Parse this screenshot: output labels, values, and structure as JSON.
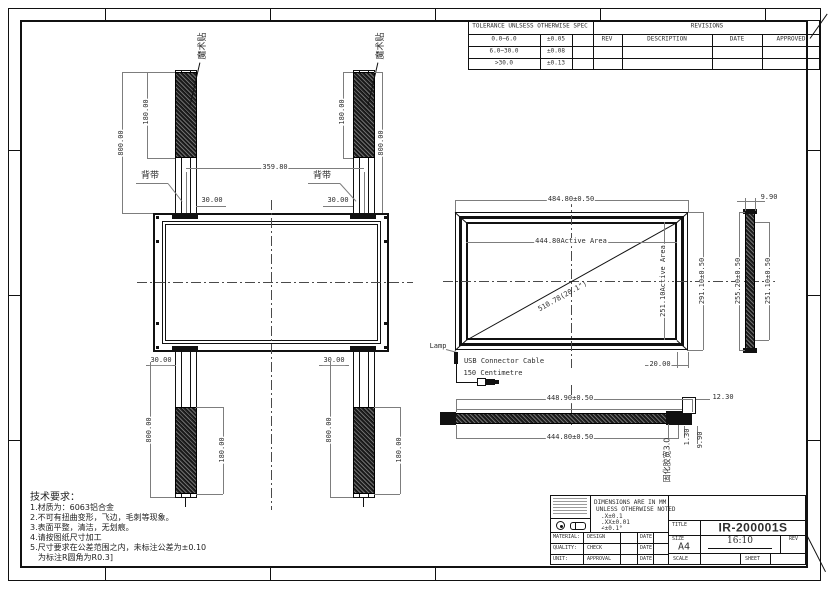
{
  "tables": {
    "tolerance": {
      "title": "TOLERANCE UNLSESS OTHERWISE SPEC",
      "rows": [
        {
          "range": "0.0~6.0",
          "tol": "±0.05"
        },
        {
          "range": "6.0~30.0",
          "tol": "±0.08"
        },
        {
          "range": ">30.0",
          "tol": "±0.13"
        }
      ]
    },
    "revisions": {
      "title": "REVISIONS",
      "col_rev": "REV",
      "col_desc": "DESCRIPTION",
      "col_date": "DATE",
      "col_approved": "APPROVED"
    }
  },
  "strap_view": {
    "velcro_label": "魔术贴",
    "strap_label": "背带",
    "velcro_length": "180.00",
    "strap_length": "800.00",
    "strap_spacing": "359.80",
    "strap_offset": "30.00"
  },
  "front_view": {
    "outer_width": "484.80±0.50",
    "active_width": "444.80Active Area",
    "active_height": "251.10Active Area",
    "outer_height": "291.10±0.50",
    "diagonal": "510.78(20.1\")",
    "corner_dim": "20.00",
    "lamp_label": "Lamp",
    "usb_label_1": "USB Connector Cable",
    "usb_label_2": "150 Centimetre"
  },
  "side_view": {
    "thickness": "9.90",
    "outer_height": "255.20±0.50",
    "active_height": "251.10±0.50"
  },
  "profile_view": {
    "outer_width": "448.90±0.50",
    "active_width": "444.80±0.50",
    "tab_height": "12.30",
    "dim_a": "1.30",
    "dim_b": "9.90",
    "glue_label": "固化胶宽3.0"
  },
  "notes": {
    "title": "技术要求：",
    "lines": [
      "1.材质为：6063铝合金",
      "2.不可有扭曲变形，飞边，毛刺等现象。",
      "3.表面平整，清洁，无划痕。",
      "4.请按图纸尺寸加工",
      "5.尺寸要求在公差范围之内，未标注公差为±0.10",
      "为标注R圆角为R0.3]"
    ]
  },
  "title_block": {
    "dim_note_1": "DIMENSIONS ARE IN MM",
    "dim_note_2": "UNLESS OTHERWISE NOTED",
    "dim_note_3": ".X±0.1",
    "dim_note_4": ".XX±0.01",
    "dim_note_5": "∠±0.1°",
    "material": "MATERIAL:",
    "quality": "QUALITY:",
    "unit": "UNIT:",
    "design": "DESIGN",
    "check": "CHECK",
    "approval": "APPROVAL",
    "date": "DATE",
    "title_label": "TITLE",
    "part_number": "IR-200001S",
    "size_label": "SIZE",
    "size": "A4",
    "aspect_ratio": "16:10",
    "rev_label": "REV",
    "scale_label": "SCALE",
    "sheet_label": "SHEET"
  }
}
